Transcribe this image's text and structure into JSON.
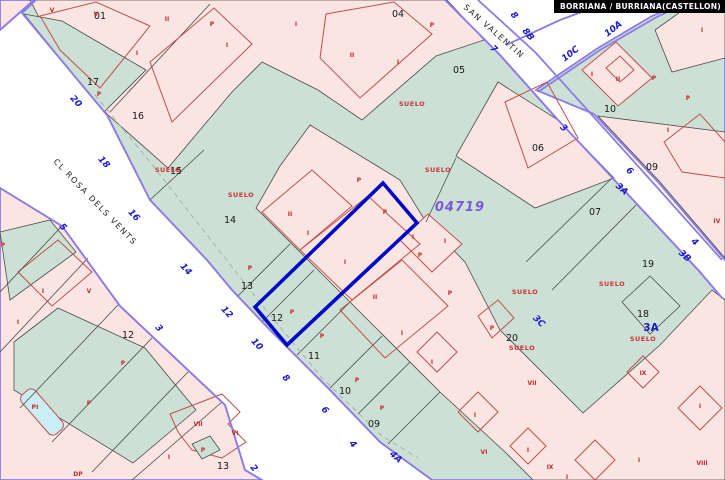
{
  "banner": {
    "municipality": "BORRIANA / BURRIANA(CASTELLON)"
  },
  "map": {
    "colors": {
      "suelo_green": "#cde0d5",
      "parcel_pink": "#fbe5e3",
      "building_red": "#c0504a",
      "street_purple": "#8d7ce6",
      "selected_blue": "#0008c8",
      "house_number_blue": "#1a1acc",
      "reference_purple": "#7a5ad8",
      "suelo_text_red": "#cc3333",
      "pool_blue": "#c9eef5",
      "banner_bg": "#000000"
    },
    "selected_parcel_reference": "04719",
    "labels": {
      "street_names": {
        "name": "street-name",
        "cls": "lbl-street",
        "interactable": false,
        "items": [
          [
            "CL ROSA DELS VENTS",
            53,
            162,
            46
          ],
          [
            "SAN VALENTIN",
            463,
            8,
            41
          ]
        ]
      },
      "block_reference": {
        "name": "block-reference",
        "cls": "lbl-ref",
        "interactable": false,
        "items": [
          [
            "04719",
            460,
            211,
            0
          ]
        ]
      },
      "parcel_numbers": {
        "name": "parcel-number",
        "cls": "lbl-parcel",
        "interactable": true,
        "items": [
          [
            "01",
            100,
            19
          ],
          [
            "04",
            398,
            17
          ],
          [
            "05",
            459,
            73
          ],
          [
            "06",
            538,
            151
          ],
          [
            "07",
            595,
            215
          ],
          [
            "09",
            652,
            170
          ],
          [
            "10",
            610,
            112
          ],
          [
            "19",
            648,
            267
          ],
          [
            "18",
            643,
            317
          ],
          [
            "20",
            512,
            341
          ],
          [
            "17",
            93,
            85
          ],
          [
            "16",
            138,
            119
          ],
          [
            "15",
            176,
            174
          ],
          [
            "14",
            230,
            223
          ],
          [
            "13",
            247,
            289
          ],
          [
            "12",
            277,
            321
          ],
          [
            "11",
            314,
            359
          ],
          [
            "10",
            345,
            394
          ],
          [
            "09",
            374,
            427
          ],
          [
            "12",
            128,
            338
          ],
          [
            "13",
            223,
            469
          ]
        ]
      },
      "house_numbers": {
        "name": "house-number",
        "cls": "lbl-house",
        "interactable": false,
        "items": [
          [
            "20",
            74,
            103,
            48
          ],
          [
            "18",
            102,
            164,
            48
          ],
          [
            "16",
            132,
            217,
            48
          ],
          [
            "14",
            184,
            271,
            48
          ],
          [
            "12",
            225,
            314,
            48
          ],
          [
            "10",
            255,
            346,
            48
          ],
          [
            "8",
            284,
            380,
            48
          ],
          [
            "6",
            323,
            412,
            48
          ],
          [
            "4",
            351,
            446,
            48
          ],
          [
            "4A",
            394,
            459,
            42
          ],
          [
            "2",
            252,
            470,
            48
          ],
          [
            "5",
            61,
            229,
            48
          ],
          [
            "3",
            157,
            330,
            48
          ],
          [
            "7",
            492,
            51,
            42
          ],
          [
            "3",
            562,
            130,
            42
          ],
          [
            "6",
            628,
            173,
            42
          ],
          [
            "3A",
            620,
            191,
            42
          ],
          [
            "4",
            693,
            244,
            42
          ],
          [
            "3B",
            683,
            258,
            42
          ],
          [
            "8B",
            526,
            36,
            52
          ],
          [
            "8",
            512,
            17,
            52
          ],
          [
            "10C",
            572,
            56,
            -38
          ],
          [
            "10A",
            615,
            31,
            -38
          ],
          [
            "3C",
            537,
            323,
            45
          ]
        ]
      },
      "house_numbers_large": {
        "name": "house-number",
        "cls": "lbl-house-big",
        "interactable": false,
        "items": [
          [
            "3A",
            651,
            331,
            0
          ]
        ]
      },
      "suelo_labels": {
        "name": "suelo-label",
        "cls": "lbl-suelo",
        "interactable": false,
        "items": [
          [
            "SUELO",
            412,
            106,
            0
          ],
          [
            "SUELO",
            438,
            172,
            0
          ],
          [
            "SUELO",
            168,
            172,
            0
          ],
          [
            "SUELO",
            241,
            197,
            0
          ],
          [
            "SUELO",
            525,
            294,
            0
          ],
          [
            "SUELO",
            612,
            286,
            0
          ],
          [
            "SUELO",
            522,
            350,
            0
          ],
          [
            "SUELO",
            643,
            341,
            0
          ]
        ]
      },
      "floor_labels": {
        "name": "floor-count-label",
        "cls": "lbl-floor",
        "interactable": false,
        "items": [
          [
            "V",
            52,
            12,
            0
          ],
          [
            "V",
            96,
            16,
            0
          ],
          [
            "II",
            167,
            21,
            0
          ],
          [
            "I",
            227,
            47,
            0
          ],
          [
            "I",
            137,
            55,
            0
          ],
          [
            "P",
            99,
            96,
            0
          ],
          [
            "P",
            212,
            26,
            0
          ],
          [
            "I",
            296,
            26,
            0
          ],
          [
            "II",
            352,
            57,
            0
          ],
          [
            "I",
            398,
            64,
            0
          ],
          [
            "P",
            432,
            27,
            0
          ],
          [
            "I",
            592,
            76,
            0
          ],
          [
            "II",
            618,
            81,
            0
          ],
          [
            "P",
            654,
            80,
            0
          ],
          [
            "P",
            688,
            100,
            0
          ],
          [
            "I",
            702,
            32,
            0
          ],
          [
            "I",
            668,
            132,
            0
          ],
          [
            "IV",
            717,
            223,
            0
          ],
          [
            "II",
            290,
            216,
            0
          ],
          [
            "I",
            308,
            235,
            0
          ],
          [
            "P",
            359,
            182,
            0
          ],
          [
            "P",
            385,
            214,
            0
          ],
          [
            "I",
            345,
            264,
            0
          ],
          [
            "I",
            413,
            239,
            0
          ],
          [
            "P",
            420,
            257,
            0
          ],
          [
            "I",
            445,
            243,
            0
          ],
          [
            "II",
            375,
            299,
            0
          ],
          [
            "I",
            402,
            335,
            0
          ],
          [
            "P",
            450,
            295,
            0
          ],
          [
            "P",
            250,
            270,
            0
          ],
          [
            "P",
            292,
            314,
            0
          ],
          [
            "P",
            322,
            338,
            0
          ],
          [
            "P",
            357,
            382,
            0
          ],
          [
            "P",
            382,
            410,
            0
          ],
          [
            "I",
            432,
            364,
            0
          ],
          [
            "I",
            475,
            417,
            0
          ],
          [
            "VI",
            484,
            454,
            0
          ],
          [
            "I",
            528,
            452,
            0
          ],
          [
            "IX",
            550,
            469,
            0
          ],
          [
            "I",
            567,
            479,
            0
          ],
          [
            "IX",
            643,
            375,
            0
          ],
          [
            "I",
            700,
            408,
            0
          ],
          [
            "I",
            639,
            462,
            0
          ],
          [
            "VIII",
            702,
            465,
            0
          ],
          [
            "VII",
            532,
            385,
            0
          ],
          [
            "P",
            492,
            330,
            0
          ],
          [
            "P",
            3,
            247,
            0
          ],
          [
            "I",
            43,
            293,
            0
          ],
          [
            "V",
            89,
            293,
            0
          ],
          [
            "I",
            18,
            324,
            0
          ],
          [
            "P",
            123,
            365,
            0
          ],
          [
            "P",
            89,
            405,
            0
          ],
          [
            "PI",
            35,
            409,
            0
          ],
          [
            "DP",
            78,
            476,
            0
          ],
          [
            "VII",
            198,
            426,
            0
          ],
          [
            "VI",
            235,
            435,
            0
          ],
          [
            "P",
            203,
            452,
            0
          ],
          [
            "I",
            169,
            459,
            0
          ]
        ]
      }
    }
  }
}
